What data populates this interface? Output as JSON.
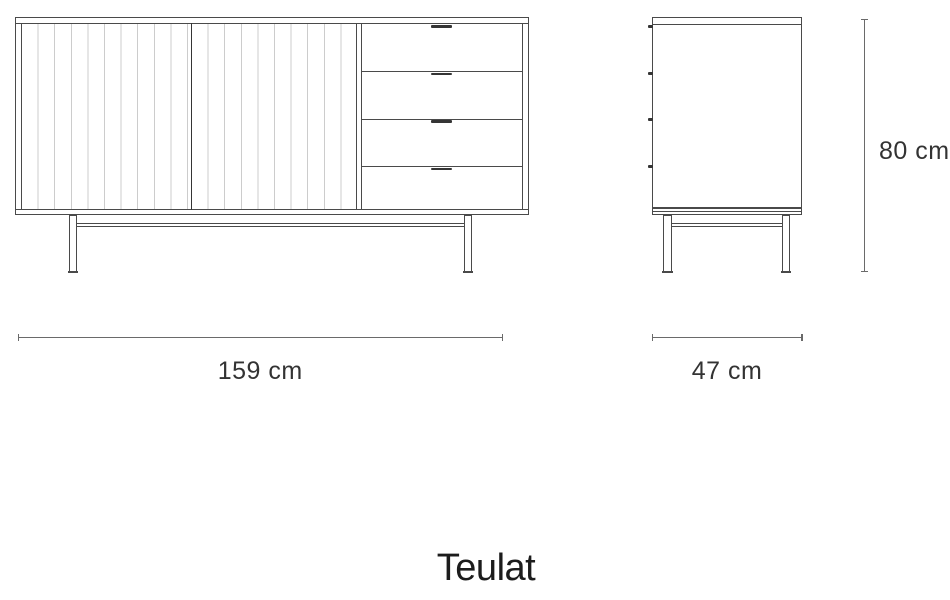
{
  "figure": {
    "type": "furniture-dimension-diagram",
    "product": "sideboard",
    "front_view": "two slatted sliding doors with four drawers on metal frame legs",
    "side_view": "side profile with four drawer handle nubs and metal frame legs"
  },
  "dimensions": {
    "width": "159 cm",
    "depth": "47 cm",
    "height": "80 cm"
  },
  "brand": {
    "logo": "Teulat"
  },
  "colors": {
    "line": "#4a4a4a",
    "slat": "#cccccc",
    "dimline": "#6a6a6a",
    "dimtext": "#333333",
    "logo": "#1c1c1c",
    "bg": "#ffffff",
    "dark": "#353535"
  }
}
